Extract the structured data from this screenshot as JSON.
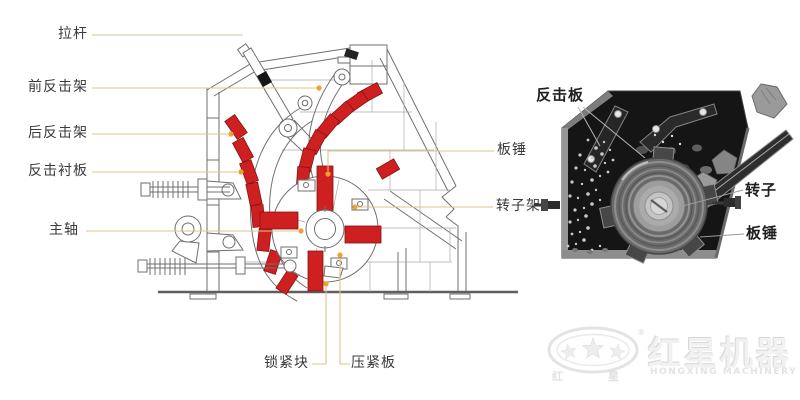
{
  "left_diagram": {
    "labels": {
      "tie_rod": "拉杆",
      "front_impact_frame": "前反击架",
      "rear_impact_frame": "后反击架",
      "impact_liner": "反击衬板",
      "main_shaft": "主轴",
      "blow_bar": "板锤",
      "rotor_frame": "转子架",
      "lock_block": "锁紧块",
      "pressing_plate": "压紧板"
    }
  },
  "right_photo": {
    "labels": {
      "impact_plate": "反击板",
      "rotor": "转子",
      "blow_bar": "板锤"
    }
  },
  "logo": {
    "cn_name": "红星机器",
    "en_name": "HONGXING MACHINERY",
    "oval_left_char": "红",
    "oval_right_char": "星",
    "registered": "®"
  },
  "colors": {
    "highlight_red": "#ce2020",
    "leader_line": "#dcc488",
    "marker_orange": "#efa032",
    "diagram_stroke": "#6f6f6f",
    "photo_background": "#151515"
  }
}
